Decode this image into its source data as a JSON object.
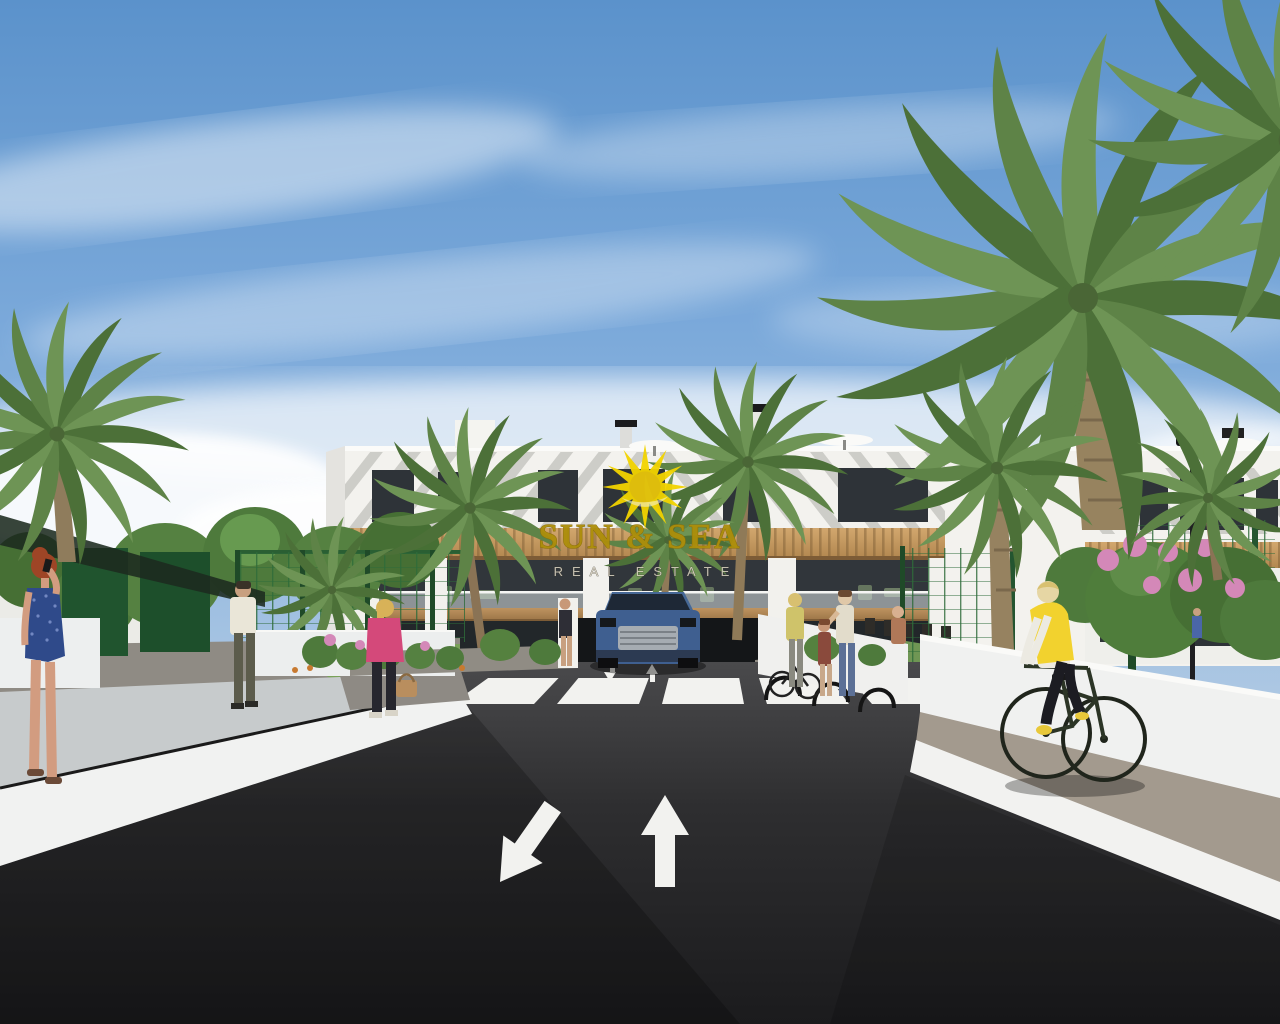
{
  "image": {
    "kind": "3D architectural real-estate rendering",
    "subject": "Modern white apartment complex with palm trees, access road with crosswalk and direction arrows, pedestrians and a cyclist under a blue sky"
  },
  "watermark": {
    "icon": "sun-logo",
    "title": "SUN & SEA",
    "subtitle": "REAL ESTATE"
  },
  "colors": {
    "sky_top": "#5B92CB",
    "sky_horizon": "#DDE2E4",
    "building_white": "#F3F2EE",
    "wood": "#C49A66",
    "window_dark": "#31363B",
    "palm_green": "#5E8347",
    "foliage_green": "#4E7A3C",
    "fence_green": "#2A5F33",
    "asphalt_dark": "#232325",
    "wall_white": "#F1F2F1",
    "road_marking_white": "#F2F2EF",
    "logo_yellow": "#F2D400",
    "logo_text_gold": "#AD8E0A",
    "car_blue": "#3F5F90",
    "vest_yellow": "#F2D22E",
    "dress_blue": "#2F4A8A",
    "jacket_pink": "#D4497A",
    "flower_pink": "#D488B8"
  },
  "scene": {
    "elements": [
      "blue sky with wispy clouds",
      "white two-storey apartment building with wood pergola bands and roof terraces",
      "roof umbrellas and chimneys",
      "palm trees and green hedges",
      "green privacy fences",
      "flower beds with pink and orange blooms",
      "dark asphalt road",
      "zebra crosswalk",
      "white boundary walls and paved side path",
      "blue SUV at garage ramp",
      "street lamp"
    ],
    "people": [
      {
        "name": "woman-red-hair",
        "detail": "blue dotted dress, phone to ear, walking on left walkway"
      },
      {
        "name": "man-white-shirt",
        "detail": "walking away on left garden path"
      },
      {
        "name": "woman-pink-jacket",
        "detail": "blonde with tan handbag crossing garden path"
      },
      {
        "name": "woman-yellow-top",
        "detail": "standing near bicycle racks"
      },
      {
        "name": "mother-and-child",
        "detail": "standing on right walkway"
      },
      {
        "name": "woman-at-pillar",
        "detail": "standing by garage pillar"
      },
      {
        "name": "cyclist-yellow-vest",
        "detail": "riding bicycle on right paved path"
      },
      {
        "name": "residents-on-balcony",
        "detail": "small figures on right balcony"
      }
    ],
    "road_markings": {
      "crosswalk_stripes": 6,
      "arrows": [
        "toward-viewer",
        "away-from-viewer"
      ]
    }
  }
}
